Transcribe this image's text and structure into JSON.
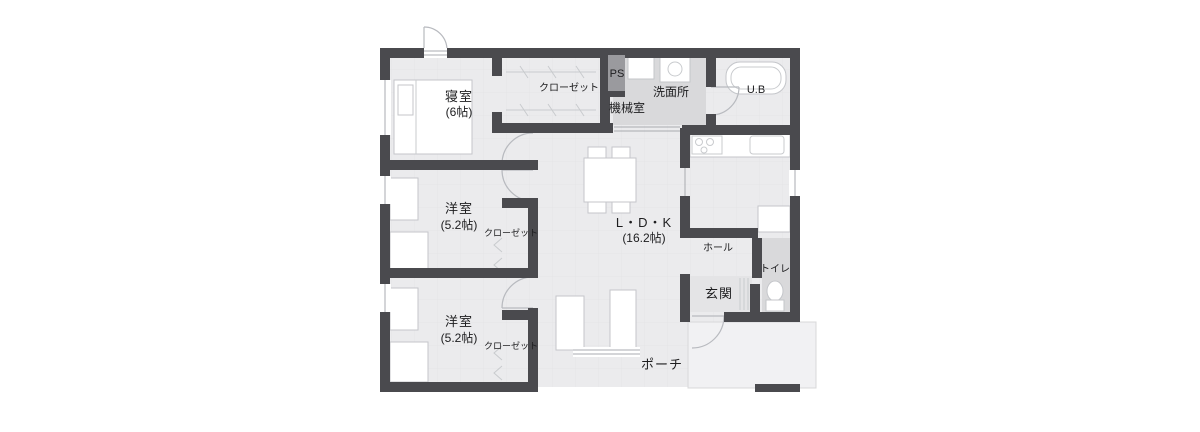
{
  "plan": {
    "title": "3LDK house floor plan",
    "rooms": {
      "bedroom": {
        "name": "寝室",
        "size": "(6帖)"
      },
      "closet_top": {
        "name": "クローゼット"
      },
      "ps": {
        "name": "PS"
      },
      "machine_room": {
        "name": "機械室"
      },
      "washroom": {
        "name": "洗面所"
      },
      "bath": {
        "name": "U.B"
      },
      "western1": {
        "name": "洋室",
        "size": "(5.2帖)"
      },
      "closet_mid": {
        "name": "クローゼット"
      },
      "western2": {
        "name": "洋室",
        "size": "(5.2帖)"
      },
      "closet_bottom": {
        "name": "クローゼット"
      },
      "ldk": {
        "name": "L・D・K",
        "size": "(16.2帖)"
      },
      "hall": {
        "name": "ホール"
      },
      "toilet": {
        "name": "トイレ"
      },
      "entrance": {
        "name": "玄関"
      },
      "porch": {
        "name": "ポーチ"
      }
    },
    "colors": {
      "wall": "#4a4a4e",
      "floor": "#ebebed",
      "wet_area": "#d9d9db",
      "ps_shaft": "#9a9a9e",
      "porch": "#f1f1f3",
      "furniture_line": "#c4c6ca",
      "text": "#1d1d1f"
    }
  }
}
